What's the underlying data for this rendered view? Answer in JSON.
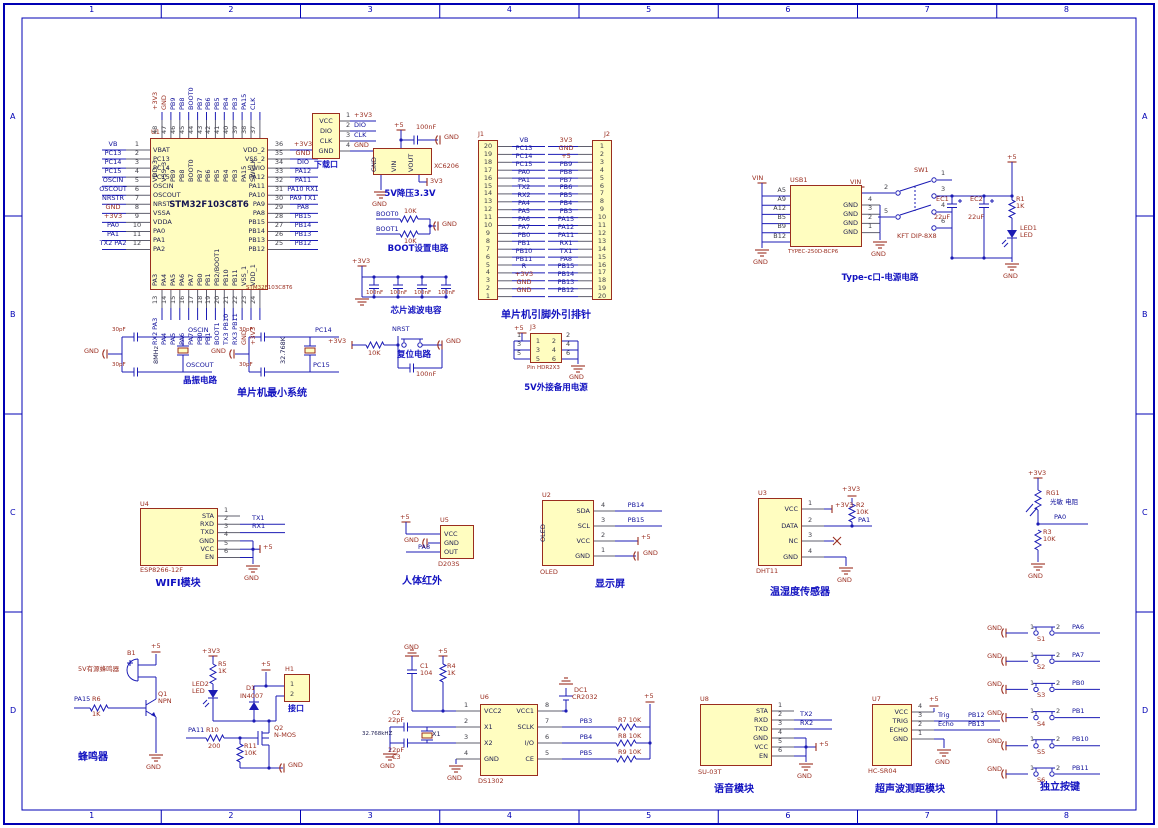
{
  "frame": {
    "cols": [
      "1",
      "2",
      "3",
      "4",
      "5",
      "6",
      "7",
      "8"
    ],
    "rows": [
      "A",
      "B",
      "C",
      "D"
    ]
  },
  "colors": {
    "wire": "#1b1bb4",
    "frame": "#0000b4",
    "part_fill": "#fffdc0",
    "part_border": "#9a2d1f",
    "power_text": "#9a2d1f",
    "net_text": "#10109a",
    "caption": "#1212c0"
  },
  "mcu": {
    "ref": "U1",
    "title": "STM32F103C8T6",
    "footer": "STM32F103C8T6",
    "left": [
      [
        "1",
        "VBAT",
        "VB"
      ],
      [
        "2",
        "PC13",
        "PC13"
      ],
      [
        "3",
        "PC14",
        "PC14"
      ],
      [
        "4",
        "PC15",
        "PC15"
      ],
      [
        "5",
        "OSCIN",
        "OSCIN"
      ],
      [
        "6",
        "OSCOUT",
        "OSCOUT"
      ],
      [
        "7",
        "NRST",
        "NRSTR"
      ],
      [
        "8",
        "VSSA",
        "GND"
      ],
      [
        "9",
        "VDDA",
        "+3V3"
      ],
      [
        "10",
        "PA0",
        "PA0"
      ],
      [
        "11",
        "PA1",
        "PA1"
      ],
      [
        "12",
        "PA2",
        "TX2 PA2"
      ]
    ],
    "right": [
      [
        "36",
        "VDD_2",
        "+3V3"
      ],
      [
        "35",
        "VSS_2",
        "GND"
      ],
      [
        "34",
        "SWIO",
        "DIO"
      ],
      [
        "33",
        "PA12",
        "PA12"
      ],
      [
        "32",
        "PA11",
        "PA11"
      ],
      [
        "31",
        "PA10",
        "PA10 RX1"
      ],
      [
        "30",
        "PA9",
        "PA9 TX1"
      ],
      [
        "29",
        "PA8",
        "PA8"
      ],
      [
        "28",
        "PB15",
        "PB15"
      ],
      [
        "27",
        "PB14",
        "PB14"
      ],
      [
        "26",
        "PB13",
        "PB13"
      ],
      [
        "25",
        "PB12",
        "PB12"
      ]
    ],
    "top": [
      [
        "48",
        "VDD_3",
        "+3V3"
      ],
      [
        "47",
        "VSS_3",
        "GND"
      ],
      [
        "46",
        "PB9",
        "PB9"
      ],
      [
        "45",
        "PB8",
        "PB8"
      ],
      [
        "44",
        "BOOT0",
        "BOOT0"
      ],
      [
        "43",
        "PB7",
        "PB7"
      ],
      [
        "42",
        "PB6",
        "PB6"
      ],
      [
        "41",
        "PB5",
        "PB5"
      ],
      [
        "40",
        "PB4",
        "PB4"
      ],
      [
        "39",
        "PB3",
        "PB3"
      ],
      [
        "38",
        "PA15",
        "PA15"
      ],
      [
        "37",
        "SWCLK",
        "CLK"
      ]
    ],
    "bottom": [
      [
        "13",
        "PA3",
        "RX2 PA3"
      ],
      [
        "14",
        "PA4",
        "PA4"
      ],
      [
        "15",
        "PA5",
        "PA5"
      ],
      [
        "16",
        "PA6",
        "PA6"
      ],
      [
        "17",
        "PA7",
        "PA7"
      ],
      [
        "18",
        "PB0",
        "PB0"
      ],
      [
        "19",
        "PB1",
        "PB1"
      ],
      [
        "20",
        "PB2/BOOT1",
        "BOOT1"
      ],
      [
        "21",
        "PB10",
        "TX3 PB10"
      ],
      [
        "22",
        "PB11",
        "RX3 PB11"
      ],
      [
        "23",
        "VSS_1",
        "GND"
      ],
      [
        "24",
        "VDD_1",
        "+3V3"
      ]
    ]
  },
  "download": {
    "caption": "下载口",
    "pins": [
      [
        "1",
        "VCC",
        "+3V3"
      ],
      [
        "2",
        "DIO",
        "DIO"
      ],
      [
        "3",
        "CLK",
        "CLK"
      ],
      [
        "4",
        "GND",
        "GND"
      ]
    ]
  },
  "reg": {
    "part": "XC6206",
    "pins": [
      "GND",
      "VIN",
      "VOUT"
    ],
    "vin": "+5",
    "cap": "100nF",
    "tap": "GND",
    "gnd": "GND",
    "out": "3V3",
    "caption": "5V降压3.3V"
  },
  "boot": {
    "rows": [
      [
        "BOOT0",
        "10K"
      ],
      [
        "BOOT1",
        "10K"
      ]
    ],
    "gnd": "GND",
    "caption": "BOOT设置电路"
  },
  "filter": {
    "pwr": "+3V3",
    "vals": [
      "100nF",
      "100nF",
      "100nF",
      "100nF"
    ],
    "caption": "芯片滤波电容"
  },
  "headers": {
    "caption": "单片机引脚外引排针",
    "j1": {
      "ref": "J1",
      "rows": [
        [
          "20",
          "VB"
        ],
        [
          "19",
          "PC13"
        ],
        [
          "18",
          "PC14"
        ],
        [
          "17",
          "PC15"
        ],
        [
          "16",
          "PA0"
        ],
        [
          "15",
          "PA1"
        ],
        [
          "14",
          "TX2"
        ],
        [
          "13",
          "RX2"
        ],
        [
          "12",
          "PA4"
        ],
        [
          "11",
          "PA5"
        ],
        [
          "10",
          "PA6"
        ],
        [
          "9",
          "PA7"
        ],
        [
          "8",
          "PB0"
        ],
        [
          "7",
          "PB1"
        ],
        [
          "6",
          "PB10"
        ],
        [
          "5",
          "PB11"
        ],
        [
          "4",
          "R"
        ],
        [
          "3",
          "+3V3"
        ],
        [
          "2",
          "GND"
        ],
        [
          "1",
          "GND"
        ]
      ]
    },
    "j2": {
      "ref": "J2",
      "rows": [
        [
          "1",
          "3V3"
        ],
        [
          "2",
          "GND"
        ],
        [
          "3",
          "+5"
        ],
        [
          "4",
          "PB9"
        ],
        [
          "5",
          "PB8"
        ],
        [
          "6",
          "PB7"
        ],
        [
          "7",
          "PB6"
        ],
        [
          "8",
          "PB5"
        ],
        [
          "9",
          "PB4"
        ],
        [
          "10",
          "PB3"
        ],
        [
          "11",
          "PA15"
        ],
        [
          "12",
          "PA12"
        ],
        [
          "13",
          "PA11"
        ],
        [
          "14",
          "RX1"
        ],
        [
          "15",
          "TX1"
        ],
        [
          "16",
          "PA8"
        ],
        [
          "17",
          "PB15"
        ],
        [
          "18",
          "PB14"
        ],
        [
          "19",
          "PB13"
        ],
        [
          "20",
          "PB12"
        ]
      ]
    }
  },
  "typec": {
    "vin": "VIN",
    "ref": "USB1",
    "part": "TYPEC-250D-BCP6",
    "gnd": "GND",
    "left": [
      [
        "A5",
        "CC1"
      ],
      [
        "A9",
        "VBUS"
      ],
      [
        "A12",
        "GND"
      ],
      [
        "B5",
        "CC2"
      ],
      [
        "B9",
        "VBUS"
      ],
      [
        "B12",
        "GND"
      ]
    ],
    "right": [
      [
        "4",
        "GND"
      ],
      [
        "3",
        "GND"
      ],
      [
        "2",
        "GND"
      ],
      [
        "1",
        "GND"
      ]
    ],
    "sw": {
      "ref": "SW1",
      "part": "KFT DIP-8X8",
      "vin": "VIN",
      "nums": [
        "1",
        "2",
        "3",
        "4",
        "5",
        "6"
      ]
    },
    "ec1": [
      "EC1",
      "22uF"
    ],
    "ec2": [
      "EC2",
      "22uF"
    ],
    "r1": [
      "R1",
      "1K"
    ],
    "led": [
      "LED1",
      "LED"
    ],
    "p5": "+5",
    "caption": "Type-c口-电源电路"
  },
  "xtal": {
    "caption1": "晶振电路",
    "caption2": "单片机最小系统",
    "g1": {
      "gnd": "GND",
      "c_top": "30pF",
      "c_bot": "30pF",
      "freq": "8MHz",
      "net_top": "OSCIN",
      "net_bot": "OSCOUT"
    },
    "g2": {
      "gnd": "GND",
      "c_top": "30pF",
      "c_bot": "30pF",
      "freq": "32.768K",
      "net_top": "PC14",
      "net_bot": "PC15"
    }
  },
  "reset": {
    "pwr": "+3V3",
    "r": "10K",
    "net": "NRST",
    "tap": "GND",
    "cap": "100nF",
    "caption": "复位电路"
  },
  "j3": {
    "ref": "J3",
    "pwr": "+5",
    "part": "Pin HDR2X3",
    "gnd": "GND",
    "lnums": [
      "1",
      "3",
      "5"
    ],
    "rnums": [
      "2",
      "4",
      "6"
    ],
    "caption": "5V外接备用电源"
  },
  "wifi": {
    "ref": "U4",
    "part": "ESP8266-12F",
    "caption": "WIFI模块",
    "p5": "+5",
    "gnd": "GND",
    "pins": [
      [
        "1",
        "STA",
        ""
      ],
      [
        "2",
        "RXD",
        "TX1"
      ],
      [
        "3",
        "TXD",
        "RX1"
      ],
      [
        "4",
        "GND",
        ""
      ],
      [
        "5",
        "VCC",
        ""
      ],
      [
        "6",
        "EN",
        ""
      ]
    ]
  },
  "pir": {
    "ref": "U5",
    "part": "D203S",
    "caption": "人体红外",
    "p5": "+5",
    "gnd": "GND",
    "net": "PA8",
    "pins": [
      "VCC",
      "GND",
      "OUT"
    ]
  },
  "oled": {
    "ref": "U2",
    "part": "OLED",
    "side": "OLED",
    "caption": "显示屏",
    "p5": "+5",
    "gnd": "GND",
    "pins": [
      [
        "4",
        "SDA",
        "PB14"
      ],
      [
        "3",
        "SCL",
        "PB15"
      ],
      [
        "2",
        "VCC",
        ""
      ],
      [
        "1",
        "GND",
        ""
      ]
    ]
  },
  "dht": {
    "ref": "U3",
    "part": "DHT11",
    "caption": "温湿度传感器",
    "pwr": "+3V3",
    "pwr2": "+3V3",
    "gnd": "GND",
    "r": [
      "R2",
      "10K"
    ],
    "net": "PA1",
    "pins": [
      [
        "1",
        "VCC"
      ],
      [
        "2",
        "DATA"
      ],
      [
        "3",
        "NC"
      ],
      [
        "4",
        "GND"
      ]
    ]
  },
  "ldr": {
    "pwr": "+3V3",
    "ref": "RG1",
    "label": "光敏 电阻",
    "net": "PA0",
    "r": [
      "R3",
      "10K"
    ],
    "gnd": "GND"
  },
  "buzzer": {
    "ref": "B1",
    "label": "5V有源蜂鸣器",
    "p5": "+5",
    "q": [
      "Q1",
      "NPN"
    ],
    "r": [
      "R6",
      "1K"
    ],
    "net": "PA15",
    "gnd": "GND",
    "caption": "蜂鸣器"
  },
  "ledblk": {
    "pwr": "+3V3",
    "r5": [
      "R5",
      "1K"
    ],
    "led": [
      "LED2",
      "LED"
    ],
    "d1": [
      "D1",
      "IN4007"
    ],
    "p5": "+5",
    "h1": "H1",
    "h1nums": [
      "1",
      "2"
    ],
    "h1cap": "接口",
    "q2": [
      "Q2",
      "N-MOS"
    ],
    "r10": [
      "R10",
      "200"
    ],
    "r11": [
      "R11",
      "10K"
    ],
    "net": "PA11",
    "gnd": "GND"
  },
  "rtc": {
    "gnd_top": "GND",
    "c1": [
      "C1",
      "104"
    ],
    "p5": "+5",
    "r4": [
      "R4",
      "1K"
    ],
    "ref": "U6",
    "part": "DS1302",
    "lpins": [
      [
        "1",
        "VCC2"
      ],
      [
        "2",
        "X1"
      ],
      [
        "3",
        "X2"
      ],
      [
        "4",
        "GND"
      ]
    ],
    "rpins": [
      [
        "8",
        "VCC1"
      ],
      [
        "7",
        "SCLK"
      ],
      [
        "6",
        "I/O"
      ],
      [
        "5",
        "CE"
      ]
    ],
    "c2": [
      "C2",
      "22pF"
    ],
    "c3": [
      "22pF",
      "C3"
    ],
    "xfreq": "32.768kHZ",
    "xref": "X1",
    "gnd1": "GND",
    "gnd2": "GND",
    "bat": [
      "DC1",
      "CR2032"
    ],
    "pullups": [
      [
        "PB3",
        "R7 10K"
      ],
      [
        "PB4",
        "R8 10K"
      ],
      [
        "PB5",
        "R9 10K"
      ]
    ],
    "pu_pwr": "+5"
  },
  "voice": {
    "ref": "U8",
    "part": "SU-03T",
    "caption": "语音模块",
    "p5": "+5",
    "gnd": "GND",
    "pins": [
      [
        "1",
        "STA",
        ""
      ],
      [
        "2",
        "RXD",
        "TX2"
      ],
      [
        "3",
        "TXD",
        "RX2"
      ],
      [
        "4",
        "GND",
        ""
      ],
      [
        "5",
        "VCC",
        ""
      ],
      [
        "6",
        "EN",
        ""
      ]
    ]
  },
  "sonar": {
    "ref": "U7",
    "part": "HC-SR04",
    "caption": "超声波测距模块",
    "p5": "+5",
    "gnd": "GND",
    "pins": [
      [
        "4",
        "VCC",
        "",
        ""
      ],
      [
        "3",
        "TRIG",
        "Trig",
        "PB12"
      ],
      [
        "2",
        "ECHO",
        "Echo",
        "PB13"
      ],
      [
        "1",
        "GND",
        "",
        ""
      ]
    ]
  },
  "keys": {
    "caption": "独立按键",
    "gnd": "GND",
    "rows": [
      [
        "S1",
        "PA6"
      ],
      [
        "S2",
        "PA7"
      ],
      [
        "S3",
        "PB0"
      ],
      [
        "S4",
        "PB1"
      ],
      [
        "S5",
        "PB10"
      ],
      [
        "S6",
        "PB11"
      ]
    ]
  }
}
